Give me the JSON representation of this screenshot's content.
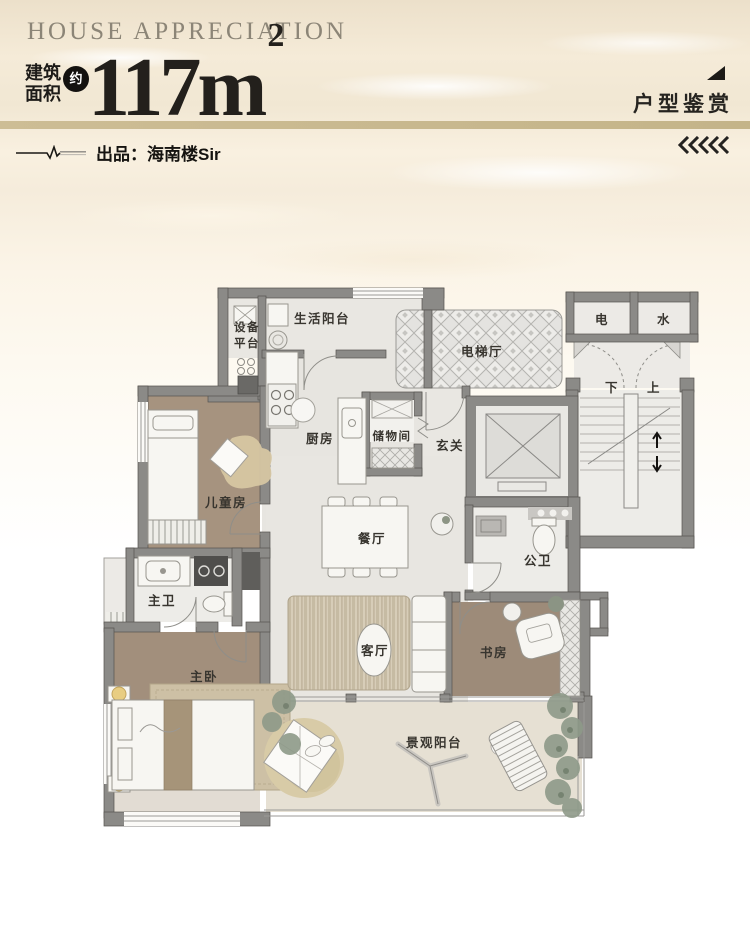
{
  "header": {
    "title_en": "HOUSE APPRECIATION",
    "area_label": {
      "line1": "建筑",
      "line2": "面积"
    },
    "approx_badge": "约",
    "area_value": "117m",
    "area_exponent": "2",
    "publisher_line": "出品：海南楼Sir",
    "corner_tag": "户型鉴赏"
  },
  "icons": {
    "pulse_line": "ecg-pulse-line",
    "corner_triangle": "solid-lower-right-triangle",
    "chevrons_left": "five-left-chevrons"
  },
  "floorplan": {
    "rooms": {
      "equipment_platform": {
        "line1": "设备",
        "line2": "平台"
      },
      "life_balcony": "生活阳台",
      "elevator_hall": "电梯厅",
      "electric_shaft": "电",
      "water_shaft": "水",
      "stairs_down": "下",
      "stairs_up": "上",
      "kitchen": "厨房",
      "storage": "储物间",
      "foyer": "玄关",
      "kids_room": "儿童房",
      "dining_room": "餐厅",
      "guest_bathroom": "公卫",
      "master_bathroom": "主卫",
      "master_bedroom": "主卧",
      "living_room": "客厅",
      "study": "书房",
      "view_balcony": "景观阳台"
    },
    "colors": {
      "wall": "#8b8a87",
      "wood_floor": "#a5927e",
      "tile_floor": "#edece8",
      "balcony_floor": "#e6e0d3",
      "accent_bar": "#c8b88f"
    }
  }
}
